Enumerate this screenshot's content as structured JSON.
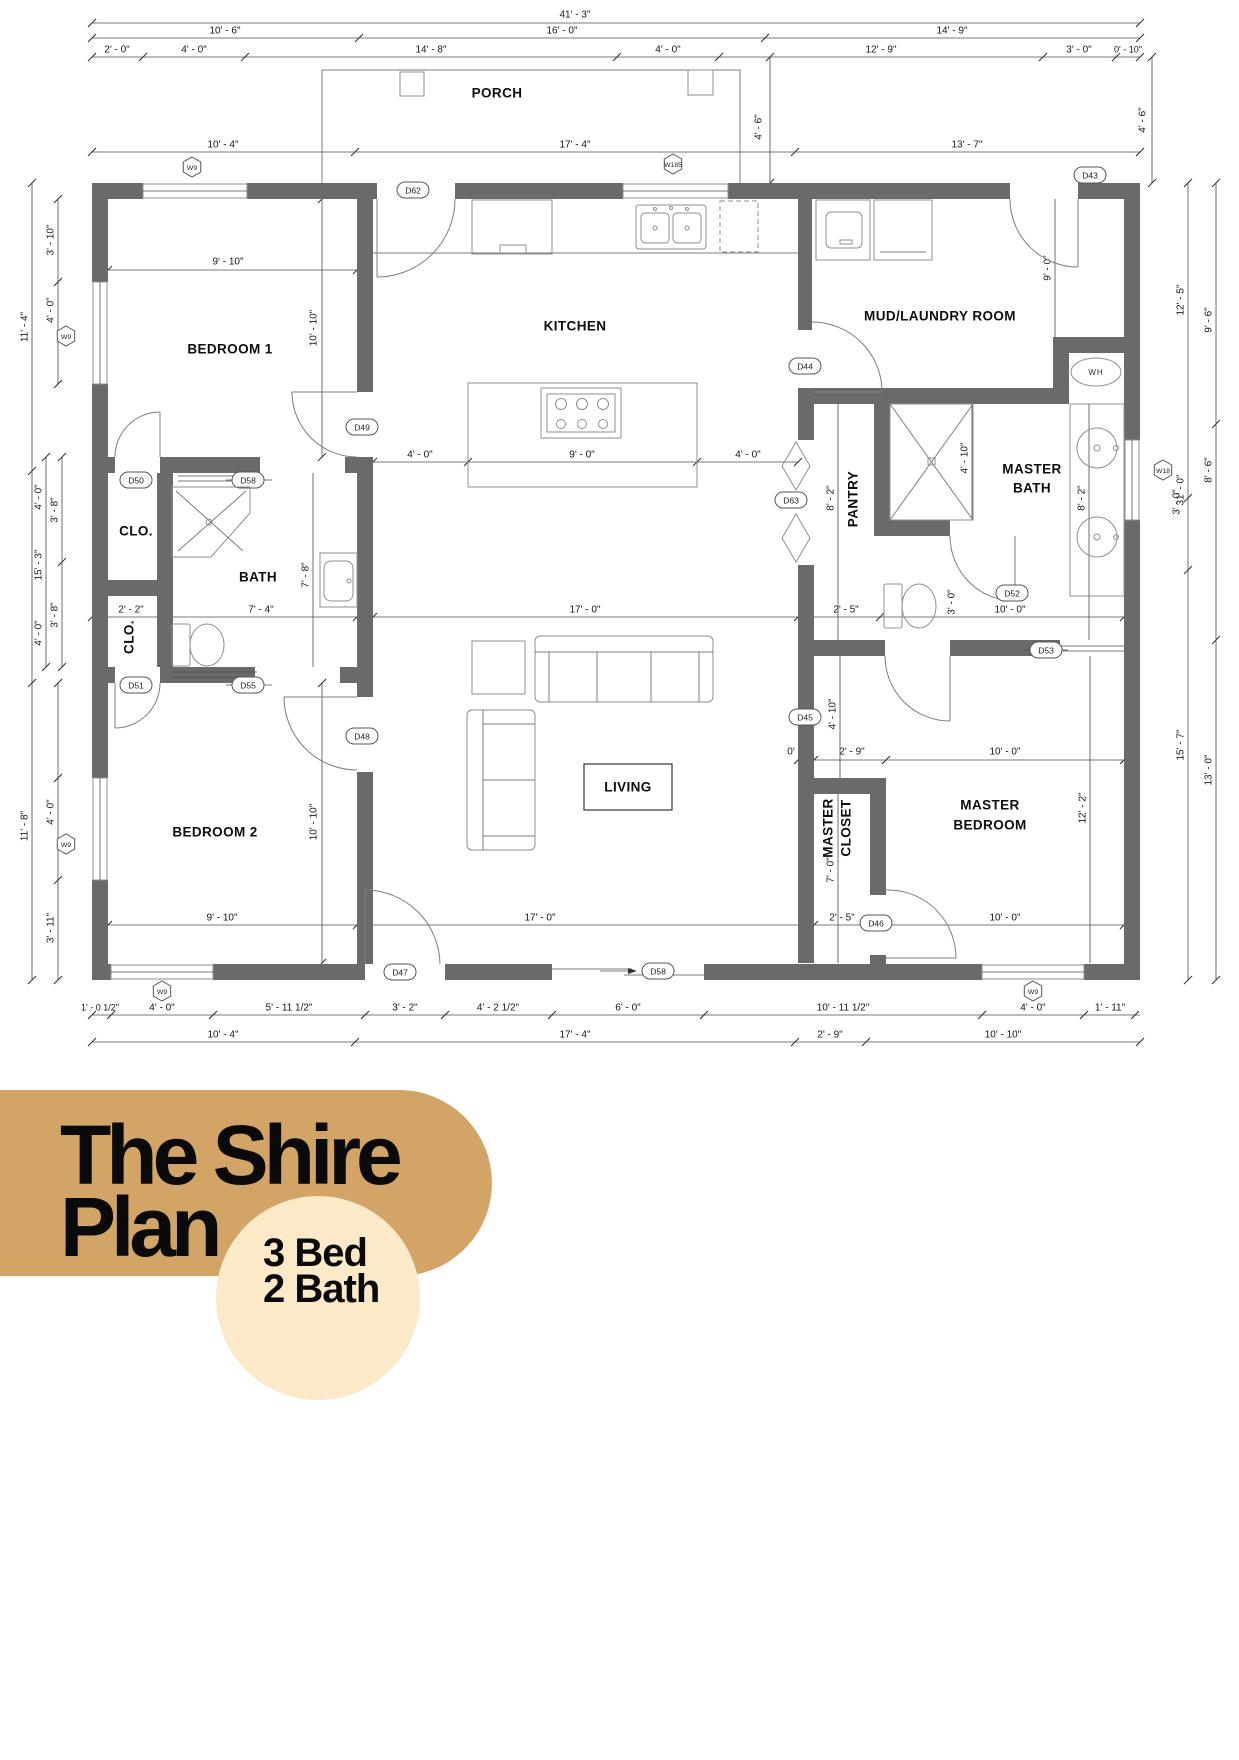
{
  "branding": {
    "title_line1": "The Shire",
    "title_line2": "Plan",
    "badge_line1": "3 Bed",
    "badge_line2": "2 Bath",
    "bar_color": "#D2A567",
    "badge_color": "#FBE9C7"
  },
  "plan": {
    "rooms": {
      "porch": "PORCH",
      "kitchen": "KITCHEN",
      "mud_laundry": "MUD/LAUNDRY ROOM",
      "bedroom1": "BEDROOM 1",
      "bedroom2": "BEDROOM 2",
      "bath": "BATH",
      "closet1": "CLO.",
      "closet2": "CLO.",
      "pantry": "PANTRY",
      "master_bath_l1": "MASTER",
      "master_bath_l2": "BATH",
      "master_bedroom_l1": "MASTER",
      "master_bedroom_l2": "BEDROOM",
      "master_closet_l1": "MASTER",
      "master_closet_l2": "CLOSET",
      "living": "LIVING",
      "water_heater": "WH"
    },
    "doors": {
      "d62": "D62",
      "d43": "D43",
      "d44": "D44",
      "d45": "D45",
      "d46": "D46",
      "d47": "D47",
      "d48": "D48",
      "d49": "D49",
      "d50": "D50",
      "d51": "D51",
      "d52": "D52",
      "d53": "D53",
      "d55": "D55",
      "d58": "D58",
      "d63": "D63"
    },
    "windows": {
      "w9": "W9",
      "w185": "W185",
      "w18": "W18"
    },
    "dims": {
      "d41_3": "41' - 3\"",
      "d10_6": "10' - 6\"",
      "d16_0": "16' - 0\"",
      "d14_9": "14' - 9\"",
      "d2_0": "2' - 0\"",
      "d4_0": "4' - 0\"",
      "d14_8": "14' - 8\"",
      "d12_9": "12' - 9\"",
      "d3_0": "3' - 0\"",
      "d0_10": "0' - 10\"",
      "d10_4": "10' - 4\"",
      "d17_4": "17' - 4\"",
      "d13_7": "13' - 7\"",
      "d4_6": "4' - 6\"",
      "d11_4": "11' - 4\"",
      "d3_10": "3' - 10\"",
      "d15_3": "15' - 3\"",
      "d3_8": "3' - 8\"",
      "d11_8": "11' - 8\"",
      "d3_11": "3' - 11\"",
      "d9_10": "9' - 10\"",
      "d10_10": "10' - 10\"",
      "d9_0": "9' - 0\"",
      "d7_8": "7' - 8\"",
      "d2_2": "2' - 2\"",
      "d7_4": "7' - 4\"",
      "d17_0": "17' - 0\"",
      "d8_2": "8' - 2\"",
      "d4_10": "4' - 10\"",
      "d2_5": "2' - 5\"",
      "d10_0": "10' - 0\"",
      "d0_0": "0' - 0\"",
      "d2_9": "2' - 9\"",
      "d12_2": "12' - 2\"",
      "d7_0": "7' - 0\"",
      "d12_5": "12' - 5\"",
      "d9_6": "9' - 6\"",
      "d8_6": "8' - 6\"",
      "d31_0": "31' - 0\"",
      "d15_7": "15' - 7\"",
      "d13_0": "13' - 0\"",
      "d1_0h": "1' - 0 1/2\"",
      "d5_11h": "5' - 11 1/2\"",
      "d3_2": "3' - 2\"",
      "d4_2h": "4' - 2 1/2\"",
      "d6_0": "6' - 0\"",
      "d10_11h": "10' - 11 1/2\"",
      "d1_11": "1' - 11\""
    }
  }
}
